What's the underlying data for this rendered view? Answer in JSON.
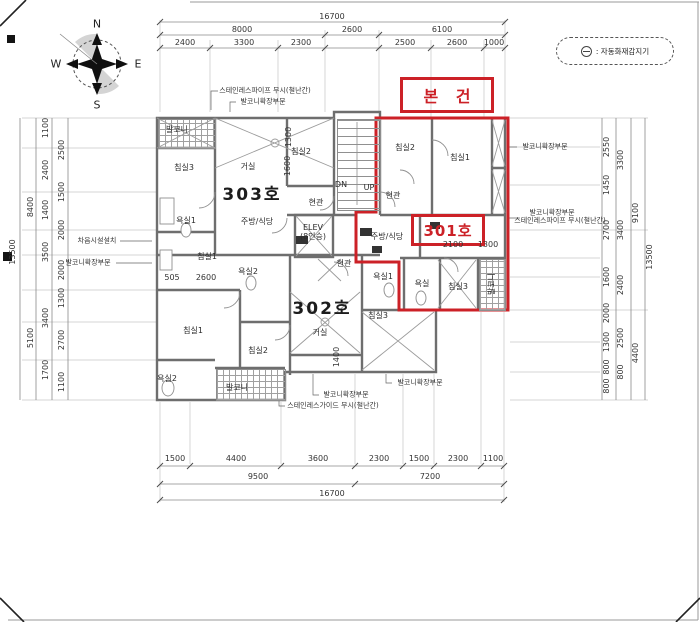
{
  "colors": {
    "accent_red": "#cc2127",
    "wall_gray": "#6e6e6e",
    "hatch_gray": "#a0a0a0"
  },
  "compass": {
    "north": "N",
    "east": "E",
    "south": "S",
    "west": "W"
  },
  "legend": {
    "symbol_name": "auto-fire-detector-icon",
    "text": ": 자동화재감지기"
  },
  "subject_marker": {
    "label": "본 건"
  },
  "unit_301_marker": {
    "label": "301호"
  },
  "plan": {
    "units": [
      {
        "t": "303호",
        "x": 252,
        "y": 196
      },
      {
        "t": "302호",
        "x": 322,
        "y": 310
      }
    ],
    "rooms": [
      {
        "t": "발코니",
        "x": 177,
        "y": 130
      },
      {
        "t": "침실3",
        "x": 184,
        "y": 168
      },
      {
        "t": "거실",
        "x": 248,
        "y": 167
      },
      {
        "t": "침실2",
        "x": 301,
        "y": 152
      },
      {
        "t": "현관",
        "x": 316,
        "y": 203
      },
      {
        "t": "주방/식당",
        "x": 257,
        "y": 222
      },
      {
        "t": "욕실1",
        "x": 186,
        "y": 221
      },
      {
        "t": "ELEV",
        "x": 313,
        "y": 228
      },
      {
        "t": "(8인승)",
        "x": 313,
        "y": 237
      },
      {
        "t": "DN",
        "x": 341,
        "y": 185
      },
      {
        "t": "UP",
        "x": 369,
        "y": 188
      },
      {
        "t": "침실1",
        "x": 207,
        "y": 257
      },
      {
        "t": "욕실2",
        "x": 248,
        "y": 272
      },
      {
        "t": "현관",
        "x": 393,
        "y": 196
      },
      {
        "t": "침실2",
        "x": 405,
        "y": 148
      },
      {
        "t": "침실1",
        "x": 460,
        "y": 158
      },
      {
        "t": "주방/식당",
        "x": 387,
        "y": 237
      },
      {
        "t": "욕실1",
        "x": 383,
        "y": 277
      },
      {
        "t": "욕실",
        "x": 422,
        "y": 284
      },
      {
        "t": "침실3",
        "x": 458,
        "y": 287
      },
      {
        "t": "발코니",
        "x": 492,
        "y": 284,
        "r": 1
      },
      {
        "t": "현관",
        "x": 344,
        "y": 264
      },
      {
        "t": "거실",
        "x": 320,
        "y": 333
      },
      {
        "t": "침실3",
        "x": 378,
        "y": 316
      },
      {
        "t": "침실2",
        "x": 258,
        "y": 351
      },
      {
        "t": "침실1",
        "x": 193,
        "y": 331
      },
      {
        "t": "욕실2",
        "x": 167,
        "y": 379
      },
      {
        "t": "발코니",
        "x": 237,
        "y": 388
      }
    ]
  },
  "dimensions": {
    "top": [
      {
        "t": "16700",
        "x": 332,
        "y": 17
      },
      {
        "t": "8000",
        "x": 242,
        "y": 30
      },
      {
        "t": "2600",
        "x": 352,
        "y": 30
      },
      {
        "t": "6100",
        "x": 442,
        "y": 30
      },
      {
        "t": "2400",
        "x": 185,
        "y": 43
      },
      {
        "t": "3300",
        "x": 244,
        "y": 43
      },
      {
        "t": "2300",
        "x": 301,
        "y": 43
      },
      {
        "t": "2500",
        "x": 405,
        "y": 43
      },
      {
        "t": "2600",
        "x": 457,
        "y": 43
      },
      {
        "t": "1000",
        "x": 494,
        "y": 43
      }
    ],
    "bottom": [
      {
        "t": "1500",
        "x": 175,
        "y": 459
      },
      {
        "t": "4400",
        "x": 236,
        "y": 459
      },
      {
        "t": "3600",
        "x": 318,
        "y": 459
      },
      {
        "t": "2300",
        "x": 379,
        "y": 459
      },
      {
        "t": "1500",
        "x": 419,
        "y": 459
      },
      {
        "t": "2300",
        "x": 458,
        "y": 459
      },
      {
        "t": "1100",
        "x": 493,
        "y": 459
      },
      {
        "t": "9500",
        "x": 258,
        "y": 477
      },
      {
        "t": "7200",
        "x": 430,
        "y": 477
      },
      {
        "t": "16700",
        "x": 332,
        "y": 494
      }
    ],
    "left": [
      {
        "t": "13500",
        "x": 13,
        "y": 252,
        "r": 1
      },
      {
        "t": "8400",
        "x": 31,
        "y": 207,
        "r": 1
      },
      {
        "t": "5100",
        "x": 31,
        "y": 338,
        "r": 1
      },
      {
        "t": "1100",
        "x": 46,
        "y": 128,
        "r": 1
      },
      {
        "t": "2400",
        "x": 46,
        "y": 170,
        "r": 1
      },
      {
        "t": "1400",
        "x": 46,
        "y": 210,
        "r": 1
      },
      {
        "t": "3500",
        "x": 46,
        "y": 252,
        "r": 1
      },
      {
        "t": "3400",
        "x": 46,
        "y": 318,
        "r": 1
      },
      {
        "t": "1700",
        "x": 46,
        "y": 370,
        "r": 1
      },
      {
        "t": "2500",
        "x": 62,
        "y": 150,
        "r": 1
      },
      {
        "t": "1500",
        "x": 62,
        "y": 192,
        "r": 1
      },
      {
        "t": "2000",
        "x": 62,
        "y": 230,
        "r": 1
      },
      {
        "t": "2000",
        "x": 62,
        "y": 270,
        "r": 1
      },
      {
        "t": "1300",
        "x": 62,
        "y": 298,
        "r": 1
      },
      {
        "t": "2700",
        "x": 62,
        "y": 340,
        "r": 1
      },
      {
        "t": "1100",
        "x": 62,
        "y": 382,
        "r": 1
      }
    ],
    "right": [
      {
        "t": "2550",
        "x": 607,
        "y": 147,
        "r": 1
      },
      {
        "t": "1450",
        "x": 607,
        "y": 185,
        "r": 1
      },
      {
        "t": "2700",
        "x": 607,
        "y": 230,
        "r": 1
      },
      {
        "t": "1600",
        "x": 607,
        "y": 277,
        "r": 1
      },
      {
        "t": "2000",
        "x": 607,
        "y": 313,
        "r": 1
      },
      {
        "t": "1300",
        "x": 607,
        "y": 342,
        "r": 1
      },
      {
        "t": "800",
        "x": 607,
        "y": 367,
        "r": 1
      },
      {
        "t": "800",
        "x": 607,
        "y": 386,
        "r": 1
      },
      {
        "t": "3300",
        "x": 621,
        "y": 160,
        "r": 1
      },
      {
        "t": "3400",
        "x": 621,
        "y": 230,
        "r": 1
      },
      {
        "t": "2400",
        "x": 621,
        "y": 285,
        "r": 1
      },
      {
        "t": "2500",
        "x": 621,
        "y": 338,
        "r": 1
      },
      {
        "t": "800",
        "x": 621,
        "y": 372,
        "r": 1
      },
      {
        "t": "9100",
        "x": 636,
        "y": 213,
        "r": 1
      },
      {
        "t": "4400",
        "x": 636,
        "y": 353,
        "r": 1
      },
      {
        "t": "13500",
        "x": 650,
        "y": 257,
        "r": 1
      }
    ],
    "interior": [
      {
        "t": "1300",
        "x": 289,
        "y": 137,
        "r": 1
      },
      {
        "t": "1600",
        "x": 288,
        "y": 166,
        "r": 1
      },
      {
        "t": "505",
        "x": 172,
        "y": 278
      },
      {
        "t": "2600",
        "x": 206,
        "y": 278
      },
      {
        "t": "2100",
        "x": 453,
        "y": 245
      },
      {
        "t": "1300",
        "x": 488,
        "y": 245
      },
      {
        "t": "1400",
        "x": 337,
        "y": 357,
        "r": 1
      }
    ]
  },
  "annotations": [
    {
      "t": "스테인레스파이프 무시(철난간)",
      "x": 265,
      "y": 91
    },
    {
      "t": "발코니확장부분",
      "x": 263,
      "y": 102
    },
    {
      "t": "차음시설설치",
      "x": 97,
      "y": 241
    },
    {
      "t": "발코니확장부분",
      "x": 88,
      "y": 263
    },
    {
      "t": "발코니확장부분",
      "x": 545,
      "y": 147
    },
    {
      "t": "발코니확장부분",
      "x": 552,
      "y": 213
    },
    {
      "t": "스테인레스파이프 무시(철난간)",
      "x": 560,
      "y": 221
    },
    {
      "t": "발코니확장부분",
      "x": 420,
      "y": 383
    },
    {
      "t": "발코니확장부분",
      "x": 346,
      "y": 395
    },
    {
      "t": "스테인레스가이드 무시(철난간)",
      "x": 333,
      "y": 406
    }
  ]
}
